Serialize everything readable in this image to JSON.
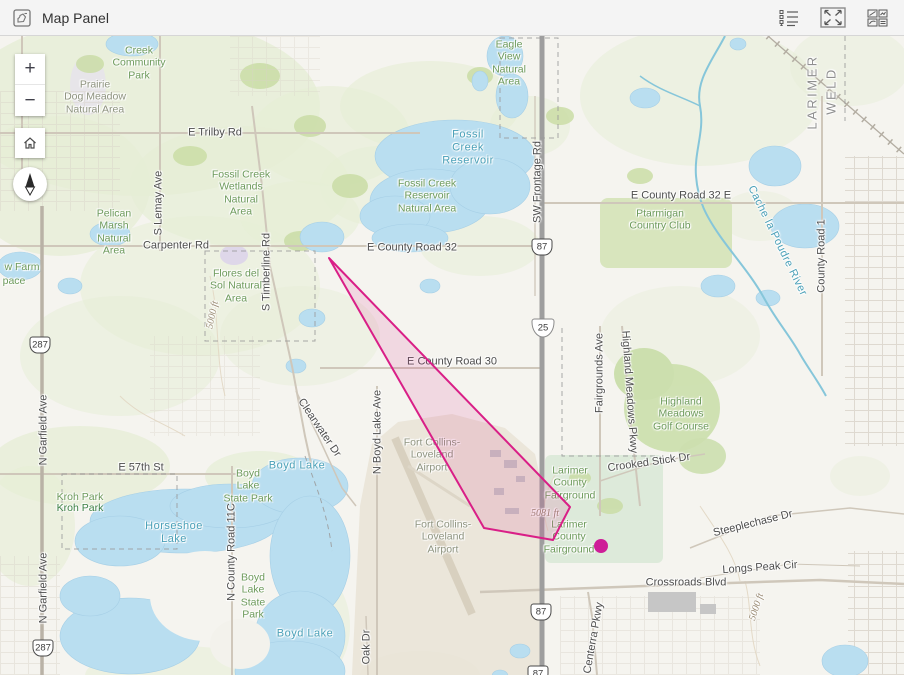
{
  "header": {
    "title": "Map Panel"
  },
  "toolbar": {
    "icons": [
      {
        "name": "legend"
      },
      {
        "name": "expand"
      },
      {
        "name": "layout-windows"
      }
    ]
  },
  "controls": {
    "zoom_in": "+",
    "zoom_out": "−"
  },
  "colors": {
    "overlay_stroke": "#d91f87",
    "overlay_fill": "rgba(217,31,135,0.13)",
    "marker": "#ce1d98",
    "water": "#b9def0"
  },
  "map": {
    "labels": [
      {
        "t": "Creek\nCommunity\nPark",
        "x": 139,
        "y": 27,
        "c": "park"
      },
      {
        "t": "Prairie\nDog Meadow\nNatural Area",
        "x": 95,
        "y": 61,
        "c": "muted"
      },
      {
        "t": "E Trilby Rd",
        "x": 215,
        "y": 97,
        "c": "road"
      },
      {
        "t": "Fossil Creek\nWetlands\nNatural\nArea",
        "x": 241,
        "y": 157,
        "c": "park"
      },
      {
        "t": "Fossil\nCreek\nReservoir",
        "x": 468,
        "y": 112,
        "c": "water"
      },
      {
        "t": "Fossil Creek\nReservoir\nNatural Area",
        "x": 427,
        "y": 160,
        "c": "park"
      },
      {
        "t": "Eagle\nView\nNatural\nArea",
        "x": 509,
        "y": 27,
        "c": "park"
      },
      {
        "t": "Pelican\nMarsh\nNatural\nArea",
        "x": 114,
        "y": 196,
        "c": "park"
      },
      {
        "t": "Carpenter Rd",
        "x": 176,
        "y": 210,
        "c": "road"
      },
      {
        "t": "S Lemay Ave",
        "x": 159,
        "y": 167,
        "c": "road",
        "r": -90
      },
      {
        "t": "S Timberline Rd",
        "x": 267,
        "y": 236,
        "c": "road",
        "r": -90
      },
      {
        "t": "Flores del\nSol Natural\nArea",
        "x": 236,
        "y": 250,
        "c": "park"
      },
      {
        "t": "w Farm",
        "x": 22,
        "y": 231,
        "c": "park"
      },
      {
        "t": "pace",
        "x": 14,
        "y": 245,
        "c": "park"
      },
      {
        "t": "5000 ft",
        "x": 213,
        "y": 279,
        "c": "contour",
        "r": -78
      },
      {
        "t": "E County Road 32",
        "x": 412,
        "y": 212,
        "c": "road"
      },
      {
        "t": "E County Road 32 E",
        "x": 681,
        "y": 160,
        "c": "road"
      },
      {
        "t": "Ptarmigan\nCountry Club",
        "x": 660,
        "y": 184,
        "c": "park"
      },
      {
        "t": "Cache la Poudre River",
        "x": 777,
        "y": 205,
        "c": "water",
        "r": 64
      },
      {
        "t": "County Road 1",
        "x": 822,
        "y": 220,
        "c": "road",
        "r": -90
      },
      {
        "t": "LARIMER",
        "x": 812,
        "y": 56,
        "c": "county",
        "r": -90
      },
      {
        "t": "WELD",
        "x": 831,
        "y": 55,
        "c": "county",
        "r": -90
      },
      {
        "t": "SW Frontage Rd",
        "x": 538,
        "y": 146,
        "c": "road",
        "r": -90
      },
      {
        "t": "E County Road 30",
        "x": 452,
        "y": 326,
        "c": "road"
      },
      {
        "t": "Fairgrounds Ave",
        "x": 600,
        "y": 337,
        "c": "road",
        "r": -90
      },
      {
        "t": "Highland Meadows Pkwy",
        "x": 629,
        "y": 356,
        "c": "road",
        "r": 86
      },
      {
        "t": "Highland\nMeadows\nGolf Course",
        "x": 681,
        "y": 378,
        "c": "park"
      },
      {
        "t": "Crooked Stick Dr",
        "x": 649,
        "y": 427,
        "c": "road",
        "r": -8
      },
      {
        "t": "Larimer\nCounty\nFairground",
        "x": 570,
        "y": 447,
        "c": "park"
      },
      {
        "t": "Larimer\nCounty\nFairground",
        "x": 569,
        "y": 501,
        "c": "park"
      },
      {
        "t": "5081 ft",
        "x": 545,
        "y": 478,
        "c": "contour"
      },
      {
        "t": "N Boyd Lake Ave",
        "x": 378,
        "y": 396,
        "c": "road",
        "r": -90
      },
      {
        "t": "Clearwater Dr",
        "x": 319,
        "y": 392,
        "c": "road",
        "r": 56
      },
      {
        "t": "Boyd Lake",
        "x": 297,
        "y": 430,
        "c": "water"
      },
      {
        "t": "Boyd Lake",
        "x": 305,
        "y": 598,
        "c": "water"
      },
      {
        "t": "Horseshoe\nLake",
        "x": 174,
        "y": 497,
        "c": "water"
      },
      {
        "t": "Boyd\nLake\nState Park",
        "x": 248,
        "y": 450,
        "c": "park"
      },
      {
        "t": "Boyd\nLake\nState\nPark",
        "x": 253,
        "y": 560,
        "c": "park"
      },
      {
        "t": "N County Road 11C",
        "x": 232,
        "y": 516,
        "c": "road",
        "r": -90
      },
      {
        "t": "Kroh Park",
        "x": 80,
        "y": 461,
        "c": "park"
      },
      {
        "t": "Kroh Park",
        "x": 80,
        "y": 472,
        "c": "parkdark"
      },
      {
        "t": "E 57th St",
        "x": 141,
        "y": 432,
        "c": "road"
      },
      {
        "t": "N Garfield Ave",
        "x": 44,
        "y": 394,
        "c": "road",
        "r": -90
      },
      {
        "t": "N Garfield Ave",
        "x": 44,
        "y": 552,
        "c": "road",
        "r": -90
      },
      {
        "t": "Fort Collins-\nLoveland\nAirport",
        "x": 432,
        "y": 419,
        "c": "muted"
      },
      {
        "t": "Fort Collins-\nLoveland\nAirport",
        "x": 443,
        "y": 501,
        "c": "muted"
      },
      {
        "t": "Steeplechase Dr",
        "x": 753,
        "y": 488,
        "c": "road",
        "r": -14
      },
      {
        "t": "Longs Peak Cir",
        "x": 760,
        "y": 532,
        "c": "road",
        "r": -4
      },
      {
        "t": "Crossroads Blvd",
        "x": 686,
        "y": 547,
        "c": "road"
      },
      {
        "t": "Centerra Pkwy",
        "x": 594,
        "y": 602,
        "c": "road",
        "r": -80
      },
      {
        "t": "Oak Dr",
        "x": 367,
        "y": 611,
        "c": "road",
        "r": -90
      },
      {
        "t": "5000 ft",
        "x": 757,
        "y": 571,
        "c": "contour",
        "r": -72
      }
    ],
    "shields": [
      {
        "k": "us",
        "t": "287",
        "x": 40,
        "y": 309
      },
      {
        "k": "us",
        "t": "287",
        "x": 43,
        "y": 612
      },
      {
        "k": "us",
        "t": "87",
        "x": 542,
        "y": 211
      },
      {
        "k": "i",
        "t": "25",
        "x": 543,
        "y": 292
      },
      {
        "k": "us",
        "t": "87",
        "x": 541,
        "y": 576
      },
      {
        "k": "us",
        "t": "87",
        "x": 538,
        "y": 638
      }
    ],
    "overlay": {
      "polygon_points": "329,222 570,471 553,504 484,492",
      "marker": {
        "x": 601,
        "y": 510,
        "r": 7
      }
    }
  }
}
